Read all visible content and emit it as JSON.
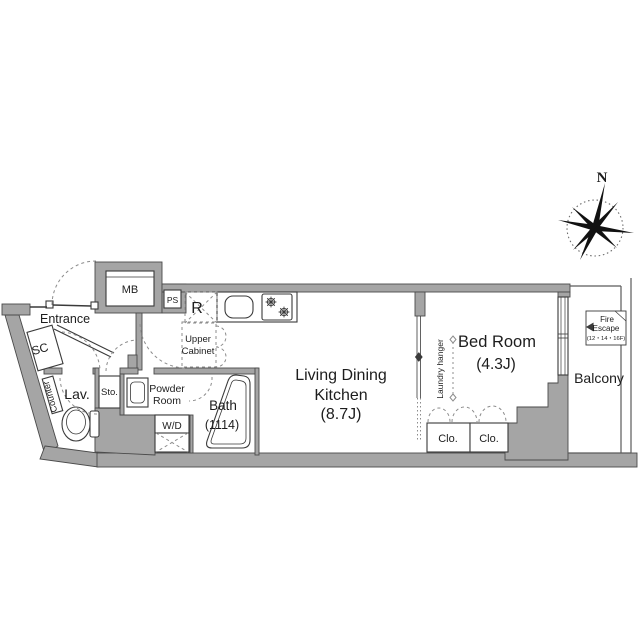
{
  "title": "apartment-floor-plan",
  "colors": {
    "wall": "#a5a5a5",
    "outline": "#4a4a4a",
    "fixture_line": "#3a3a3a",
    "dash_line": "#8c8c8c",
    "text": "#1d1d1d"
  },
  "compass": {
    "north_label": "N"
  },
  "rooms": {
    "entrance": {
      "label": "Entrance"
    },
    "shoe_cabinet": {
      "label": "SC"
    },
    "counter": {
      "label": "Counter"
    },
    "lavatory": {
      "label": "Lav."
    },
    "storage": {
      "label": "Sto."
    },
    "powder_room": {
      "line1": "Powder",
      "line2": "Room"
    },
    "washer_dryer": {
      "label": "W/D"
    },
    "bath": {
      "line1": "Bath",
      "line2": "(1114)"
    },
    "ldk": {
      "line1": "Living Dining",
      "line2": "Kitchen",
      "line3": "(8.7J)"
    },
    "bedroom": {
      "line1": "Bed Room",
      "line2": "(4.3J)"
    },
    "closet_left": {
      "label": "Clo."
    },
    "closet_right": {
      "label": "Clo."
    },
    "balcony": {
      "label": "Balcony"
    }
  },
  "fixtures": {
    "meter_box": {
      "label": "MB"
    },
    "pipe_space": {
      "label": "PS"
    },
    "refrigerator_space": {
      "label": "R"
    },
    "upper_cabinet": {
      "line1": "Upper",
      "line2": "Cabinet"
    },
    "laundry_hanger": {
      "label": "Laundry hanger"
    },
    "fire_escape": {
      "line1": "Fire",
      "line2": "Escape",
      "line3": "(12・14・16F)"
    }
  }
}
